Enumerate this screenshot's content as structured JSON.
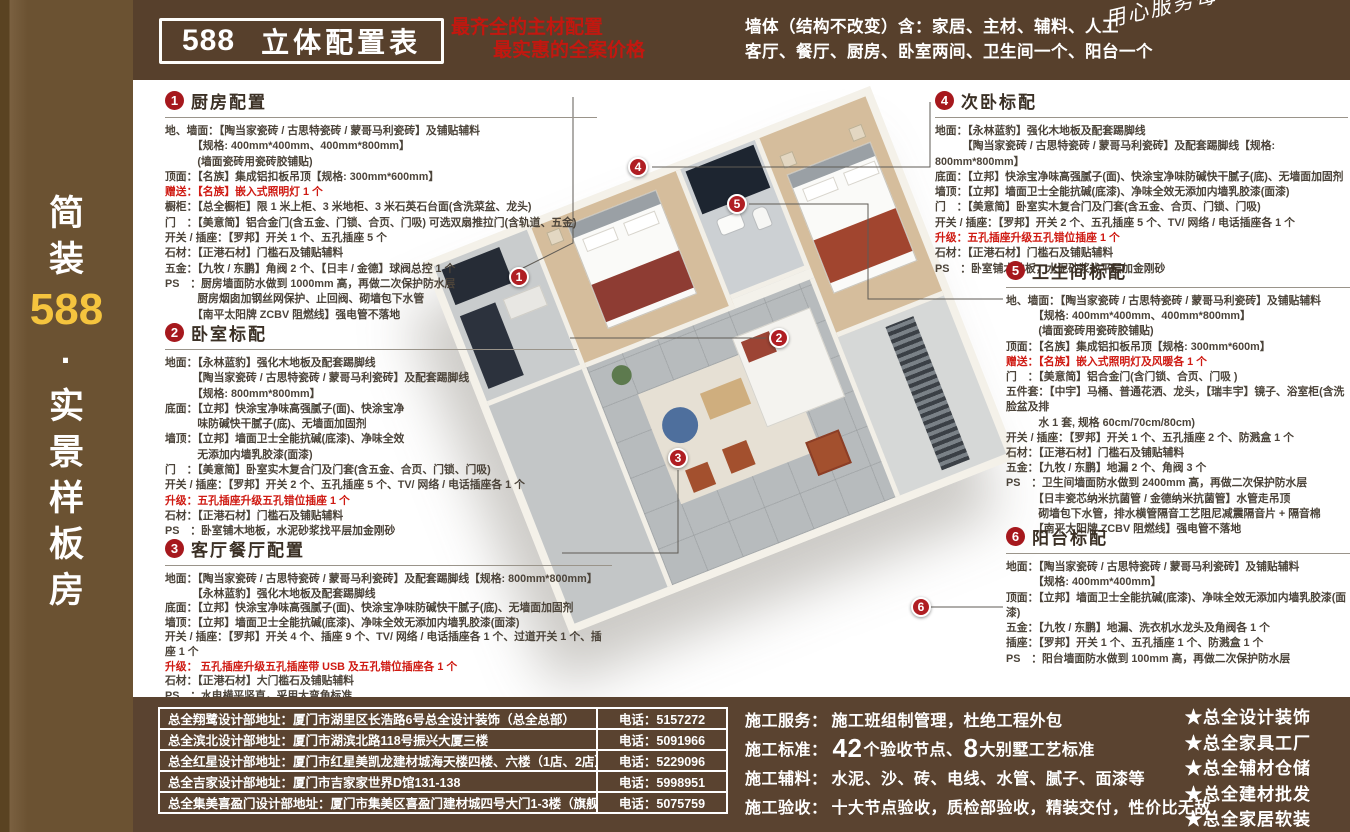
{
  "sidebar": {
    "chars": [
      {
        "t": "简"
      },
      {
        "t": "装"
      },
      {
        "t": "588",
        "c": "gold"
      },
      {
        "t": "·"
      },
      {
        "t": "实"
      },
      {
        "t": "景"
      },
      {
        "t": "样"
      },
      {
        "t": "板"
      },
      {
        "t": "房"
      }
    ]
  },
  "header": {
    "badge_number": "588",
    "badge_title": "立体配置表",
    "red_line1": "最齐全的主材配置",
    "red_line2": "最实惠的全案价格",
    "white_line1": "墙体（结构不改变）含：家居、主材、辅料、人工",
    "white_line2": "客厅、餐厅、厨房、卧室两间、卫生间一个、阳台一个",
    "script_note": "用心服务每一个细节！！！"
  },
  "sections": [
    {
      "num": "1",
      "title": "厨房配置",
      "lines": [
        {
          "t": "地、墙面：【陶当家瓷砖 / 古思特瓷砖 / 蒙哥马利瓷砖】及铺贴辅料"
        },
        {
          "t": "　　　【规格: 400mm*400mm、400mm*800mm】"
        },
        {
          "t": "　　　(墙面瓷砖用瓷砖胶铺贴)"
        },
        {
          "t": "顶面：【名族】集成铝扣板吊顶【规格: 300mm*600mm】"
        },
        {
          "t": "赠送：【名族】嵌入式照明灯 1 个",
          "c": "red"
        },
        {
          "t": "橱柜：【总全橱柜】限 1 米上柜、3 米地柜、3 米石英石台面(含洗菜盆、龙头)"
        },
        {
          "t": "门　：【美意简】铝合金门(含五金、门锁、合页、门吸) 可选双扇推拉门(含轨道、五金)"
        },
        {
          "t": "开关 / 插座：【罗邦】开关 1 个、五孔插座 5 个"
        },
        {
          "t": "石材：【正港石材】门槛石及铺贴辅料"
        },
        {
          "t": "五金：【九牧 / 东鹏】角阀 2 个、【日丰 / 金德】球阀总控 1 个"
        },
        {
          "t": "PS　：厨房墙面防水做到 1000mm 高，再做二次保护防水层"
        },
        {
          "t": "　　　厨房烟囱加钢丝网保护、止回阀、砌墙包下水管"
        },
        {
          "t": "　　　【南平太阳牌 ZCBV 阻燃线】强电管不落地"
        }
      ]
    },
    {
      "num": "2",
      "title": "卧室标配",
      "lines": [
        {
          "t": "地面：【永林蓝豹】强化木地板及配套踢脚线"
        },
        {
          "t": "　　　【陶当家瓷砖 / 古思特瓷砖 / 蒙哥马利瓷砖】及配套踢脚线"
        },
        {
          "t": "　　　【规格: 800mm*800mm】"
        },
        {
          "t": "底面：【立邦】快涂宝净味高强腻子(面)、快涂宝净"
        },
        {
          "t": "　　　味防碱快干腻子(底)、无墙面加固剂"
        },
        {
          "t": "墙顶：【立邦】墙面卫士全能抗碱(底漆)、净味全效"
        },
        {
          "t": "　　　无添加内墙乳胶漆(面漆)"
        },
        {
          "t": "门　：【美意简】卧室实木复合门及门套(含五金、合页、门锁、门吸)"
        },
        {
          "t": "开关 / 插座：【罗邦】开关 2 个、五孔插座 5 个、TV/ 网络 / 电话插座各 1 个"
        },
        {
          "t": "升级：五孔插座升级五孔错位插座 1 个",
          "c": "red"
        },
        {
          "t": "石材：【正港石材】门槛石及铺贴辅料"
        },
        {
          "t": "PS　：卧室铺木地板，水泥砂浆找平层加金刚砂"
        }
      ]
    },
    {
      "num": "3",
      "title": "客厅餐厅配置",
      "lines": [
        {
          "t": "地面：【陶当家瓷砖 / 古思特瓷砖 / 蒙哥马利瓷砖】及配套踢脚线【规格: 800mm*800mm】"
        },
        {
          "t": "　　　【永林蓝豹】强化木地板及配套踢脚线"
        },
        {
          "t": "底面：【立邦】快涂宝净味高强腻子(面)、快涂宝净味防碱快干腻子(底)、无墙面加固剂"
        },
        {
          "t": "墙顶：【立邦】墙面卫士全能抗碱(底漆)、净味全效无添加内墙乳胶漆(面漆)"
        },
        {
          "t": "开关 / 插座：【罗邦】开关 4 个、插座 9 个、TV/ 网络 / 电话插座各 1 个、过道开关 1 个、插座 1 个"
        },
        {
          "t": "升级： 五孔插座升级五孔插座带 USB 及五孔错位插座各 1 个",
          "c": "red"
        },
        {
          "t": "石材：【正港石材】大门槛石及铺贴辅料"
        },
        {
          "t": "PS　：水电横平竖直，采用大弯角标准"
        }
      ]
    },
    {
      "num": "4",
      "title": "次卧标配",
      "lines": [
        {
          "t": "地面：【永林蓝豹】强化木地板及配套踢脚线"
        },
        {
          "t": "　　　【陶当家瓷砖 / 古思特瓷砖 / 蒙哥马利瓷砖】及配套踢脚线【规格: 800mm*800mm】"
        },
        {
          "t": "底面：【立邦】快涂宝净味高强腻子(面)、快涂宝净味防碱快干腻子(底)、无墙面加固剂"
        },
        {
          "t": "墙顶：【立邦】墙面卫士全能抗碱(底漆)、净味全效无添加内墙乳胶漆(面漆)"
        },
        {
          "t": "门　：【美意简】卧室实木复合门及门套(含五金、合页、门锁、门吸)"
        },
        {
          "t": "开关 / 插座：【罗邦】开关 2 个、五孔插座 5 个、TV/ 网络 / 电话插座各 1 个"
        },
        {
          "t": "升级：五孔插座升级五孔错位插座 1 个",
          "c": "red"
        },
        {
          "t": "石材：【正港石材】门槛石及铺贴辅料"
        },
        {
          "t": "PS　：卧室铺木地板，水泥砂浆找平层加金刚砂"
        }
      ]
    },
    {
      "num": "5",
      "title": "卫生间标配",
      "lines": [
        {
          "t": "地、墙面：【陶当家瓷砖 / 古思特瓷砖 / 蒙哥马利瓷砖】及铺贴辅料"
        },
        {
          "t": "　　　【规格: 400mm*400mm、400mm*800mm】"
        },
        {
          "t": "　　　(墙面瓷砖用瓷砖胶铺贴)"
        },
        {
          "t": "顶面：【名族】集成铝扣板吊顶【规格: 300mm*600m】"
        },
        {
          "t": "赠送：【名族】嵌入式照明灯及风暖各 1 个",
          "c": "red"
        },
        {
          "t": "门　：【美意简】铝合金门(含门锁、合页、门吸 )"
        },
        {
          "t": "五件套：【中宇】马桶、普通花洒、龙头，【瑞丰宇】镜子、浴室柜(含洗脸盆及排"
        },
        {
          "t": "　　　水 1 套, 规格 60cm/70cm/80cm)"
        },
        {
          "t": "开关 / 插座：【罗邦】开关 1 个、五孔插座 2 个、防溅盒 1 个"
        },
        {
          "t": "石材：【正港石材】门槛石及铺贴辅料"
        },
        {
          "t": "五金：【九牧 / 东鹏】地漏 2 个、角阀 3 个"
        },
        {
          "t": "PS　：卫生间墙面防水做到 2400mm 高，再做二次保护防水层"
        },
        {
          "t": "　　　【日丰瓷芯纳米抗菌管 / 金德纳米抗菌管】水管走吊顶"
        },
        {
          "t": "　　　砌墙包下水管，排水横管隔音工艺阻尼减震隔音片 + 隔音棉"
        },
        {
          "t": "　　　【南平太阳牌 ZCBV 阻燃线】强电管不落地"
        }
      ]
    },
    {
      "num": "6",
      "title": "阳台标配",
      "lines": [
        {
          "t": "地面：【陶当家瓷砖 / 古思特瓷砖 / 蒙哥马利瓷砖】及铺贴辅料"
        },
        {
          "t": "　　　【规格: 400mm*400mm】"
        },
        {
          "t": "顶面：【立邦】墙面卫士全能抗碱(底漆)、净味全效无添加内墙乳胶漆(面漆)"
        },
        {
          "t": "五金：【九牧 / 东鹏】地漏、洗衣机水龙头及角阀各 1 个"
        },
        {
          "t": "插座：【罗邦】开关 1 个、五孔插座 1 个、防溅盒 1 个"
        },
        {
          "t": "PS　：阳台墙面防水做到 100mm 高，再做二次保护防水层"
        }
      ]
    }
  ],
  "plan": {
    "markers": [
      {
        "n": "1",
        "x": 519,
        "y": 277
      },
      {
        "n": "2",
        "x": 779,
        "y": 338
      },
      {
        "n": "3",
        "x": 678,
        "y": 458
      },
      {
        "n": "4",
        "x": 638,
        "y": 167
      },
      {
        "n": "5",
        "x": 737,
        "y": 204
      },
      {
        "n": "6",
        "x": 921,
        "y": 607
      }
    ]
  },
  "footer": {
    "locations": [
      {
        "address": "总全翔鹭设计部地址：厦门市湖里区长浩路6号总全设计装饰（总全总部）",
        "phone": "电话：5157272"
      },
      {
        "address": "总全滨北设计部地址：厦门市湖滨北路118号振兴大厦三楼",
        "phone": "电话：5091966"
      },
      {
        "address": "总全红星设计部地址：厦门市红星美凯龙建材城海天楼四楼、六楼（1店、2店）",
        "phone": "电话：5229096"
      },
      {
        "address": "总全吉家设计部地址：厦门市吉家家世界D馆131-138",
        "phone": "电话：5998951"
      },
      {
        "address": "总全集美喜盈门设计部地址：厦门市集美区喜盈门建材城四号大门1-3楼（旗舰店）",
        "phone": "电话：5075759"
      }
    ],
    "services": {
      "row1": {
        "label": "施工服务：",
        "text": "施工班组制管理，杜绝工程外包"
      },
      "row2": {
        "label": "施工标准：",
        "big1": "42",
        "mid": "个验收节点、",
        "big2": "8",
        "tail": "大别墅工艺标准"
      },
      "row3": {
        "label": "施工辅料：",
        "text": "水泥、沙、砖、电线、水管、腻子、面漆等"
      },
      "row4": {
        "label": "施工验收：",
        "text": "十大节点验收，质检部验收，精装交付，性价比无敌"
      }
    },
    "stars": [
      {
        "t": "★总全设计装饰"
      },
      {
        "t": "★总全家具工厂"
      },
      {
        "t": "★总全辅材仓储"
      },
      {
        "t": "★总全建材批发"
      },
      {
        "t": "★总全家居软装"
      }
    ]
  }
}
